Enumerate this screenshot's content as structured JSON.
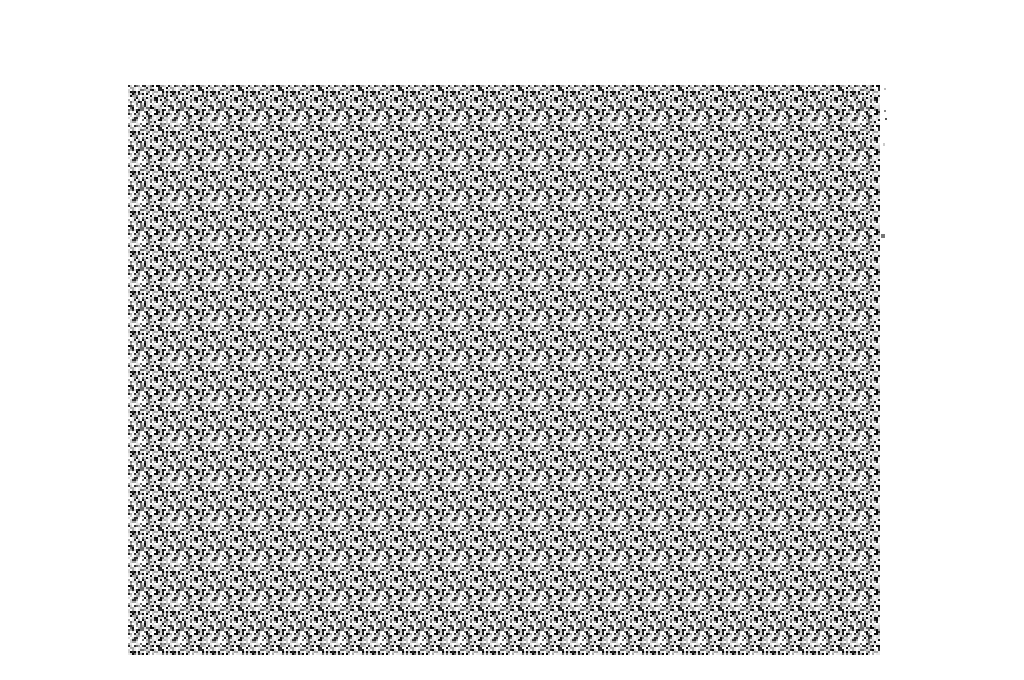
{
  "page": {
    "width": 1024,
    "height": 680,
    "background_color": "#ffffff"
  },
  "noise_image": {
    "label": "static-noise-pattern",
    "description": "Rectangular field of fine black, white and gray static noise (TV-static style) with a subtle repeating tile texture, centered on an otherwise blank white page. No text or UI controls are visible.",
    "x": 128,
    "y": 85,
    "width": 752,
    "height": 570,
    "cell_size_px": 2,
    "tile_size_px": 40,
    "seed": 20240613,
    "palette": [
      "#ffffff",
      "#e8e8e8",
      "#cfcfcf",
      "#a8a8a8",
      "#6e6e6e",
      "#2e2e2e",
      "#0a0a0a"
    ],
    "weights": [
      0.2,
      0.18,
      0.15,
      0.12,
      0.09,
      0.11,
      0.15
    ]
  },
  "artifacts": {
    "description": "Tiny stray gray specks just outside the right edge of the noise rectangle",
    "specks": [
      {
        "x": 884,
        "y": 88,
        "w": 2,
        "h": 2,
        "color": "#bbbbbb"
      },
      {
        "x": 884,
        "y": 110,
        "w": 2,
        "h": 2,
        "color": "#888888"
      },
      {
        "x": 885,
        "y": 118,
        "w": 2,
        "h": 2,
        "color": "#555555"
      },
      {
        "x": 883,
        "y": 143,
        "w": 2,
        "h": 3,
        "color": "#cccccc"
      },
      {
        "x": 881,
        "y": 234,
        "w": 4,
        "h": 4,
        "color": "#777777"
      }
    ]
  }
}
